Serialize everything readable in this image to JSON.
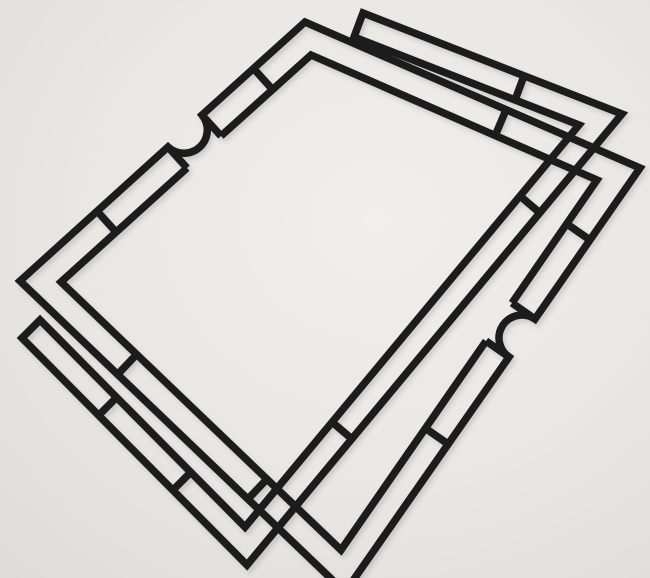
{
  "scene": {
    "description": "Photograph of two black die-cut frame outlines overlapping diagonally on a light gray surface. Each frame is a thin black strip border divided into rectangular cells by rungs; the upper frame has semicircular thumb-notches bulging outward on its upper-left and lower-right sides. The lower U-shaped frame has flat end caps and nests almost parallel to the upper frame along the top-right and lower-left bands, leaving a large empty white center.",
    "viewbox": "0 0 650 578",
    "background": {
      "center_color": "#edecе9",
      "light": "#f0efec",
      "base": "#e9e7e3",
      "edge_dark": "#dedcd8"
    },
    "ink": {
      "color": "#1a1b1e",
      "stroke_width": 7.5
    },
    "shadow": {
      "dx": 2.5,
      "dy": 3.5,
      "blur": 2.2,
      "opacity": 0.18
    },
    "frames": [
      {
        "name": "lower-frame",
        "paths": [
          {
            "name": "lower-frame-outline",
            "d": "M 363 13 L 622 114 L 247 565 L 22 338 L 40 320 L 245 527 L 579 125 L 354 37 Z"
          },
          {
            "name": "lower-frame-divider",
            "d": "M 524 76 L 515 100"
          },
          {
            "name": "lower-frame-divider",
            "d": "M 540 213 L 520 196"
          },
          {
            "name": "lower-frame-divider",
            "d": "M 352 439 L 332 422"
          },
          {
            "name": "lower-frame-divider",
            "d": "M 173 490 L 191 472"
          },
          {
            "name": "lower-frame-divider",
            "d": "M 99 415 L 117 397"
          }
        ]
      },
      {
        "name": "upper-frame",
        "paths": [
          {
            "name": "upper-frame-outer-outline",
            "d": "M 20 281 L 168 147 A 23.4 23.4 0 0 0 202 115 L 305 22 L 640 168 L 535 319 A 23 23 0 0 0 509 357 L 345 592 Z"
          },
          {
            "name": "upper-frame-inner-outline-a",
            "d": "M 486 341 L 341 550 L 61 282 L 187 168"
          },
          {
            "name": "upper-frame-inner-outline-b",
            "d": "M 221 136 L 311 55 L 597 180 L 512 303"
          },
          {
            "name": "notch-shoulder",
            "d": "M 168 147 L 187 168"
          },
          {
            "name": "notch-shoulder",
            "d": "M 202 115 L 221 136"
          },
          {
            "name": "notch-shoulder",
            "d": "M 535 319 L 512 303"
          },
          {
            "name": "notch-shoulder",
            "d": "M 509 357 L 486 341"
          },
          {
            "name": "upper-frame-divider",
            "d": "M 97 211 L 116 232"
          },
          {
            "name": "upper-frame-divider",
            "d": "M 254 69 L 273 90"
          },
          {
            "name": "upper-frame-divider",
            "d": "M 506 110 L 495 136"
          },
          {
            "name": "upper-frame-divider",
            "d": "M 590 240 L 567 224"
          },
          {
            "name": "upper-frame-divider",
            "d": "M 448 444 L 425 428"
          },
          {
            "name": "upper-frame-divider",
            "d": "M 118 374 L 137 354"
          },
          {
            "name": "upper-frame-divider",
            "d": "M 248 499 L 267 479"
          }
        ]
      }
    ]
  }
}
